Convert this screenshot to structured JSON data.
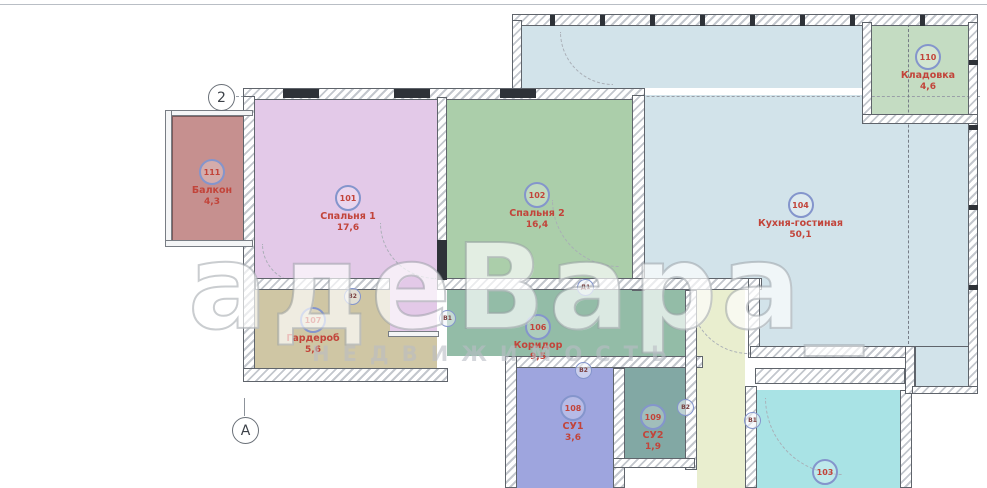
{
  "plan_type": "apartment-floor-plan",
  "watermark": {
    "line1": "адеВара_",
    "line2": "НЕДВИЖИМОСТЬ"
  },
  "grid_markers": {
    "col": "2",
    "row": "А"
  },
  "rooms": [
    {
      "number": "101",
      "name": "Спальня 1",
      "area": "17,6"
    },
    {
      "number": "102",
      "name": "Спальня 2",
      "area": "16,4"
    },
    {
      "number": "103"
    },
    {
      "number": "104",
      "name": "Кухня-гостиная",
      "area": "50,1"
    },
    {
      "number": "106",
      "name": "Коридор",
      "area": "9,5"
    },
    {
      "number": "107",
      "name": "Гардероб",
      "area": "5,6"
    },
    {
      "number": "108",
      "name": "СУ1",
      "area": "3,6"
    },
    {
      "number": "109",
      "name": "СУ2",
      "area": "1,9"
    },
    {
      "number": "110",
      "name": "Кладовка",
      "area": "4,6"
    },
    {
      "number": "111",
      "name": "Балкон",
      "area": "4,3"
    }
  ],
  "door_markers": [
    {
      "label": "В2"
    },
    {
      "label": "В1"
    },
    {
      "label": "Д1"
    },
    {
      "label": "В2"
    },
    {
      "label": "В2"
    },
    {
      "label": "В1"
    }
  ],
  "colors": {
    "bedroom1": "#e3c9e8",
    "bedroom2": "#abceaa",
    "kitchen_living": "#d2e3ea",
    "kladovka": "#c4dcc2",
    "balcony": "#c6908f",
    "wardrobe": "#cfc6a4",
    "corridor": "#93bca7",
    "su1": "#9ea5de",
    "su2": "#82a8a4",
    "hallway": "#e9eecf",
    "room103": "#a9e3e5",
    "label_red": "#c2443a",
    "badge_blue": "#8495cc"
  }
}
